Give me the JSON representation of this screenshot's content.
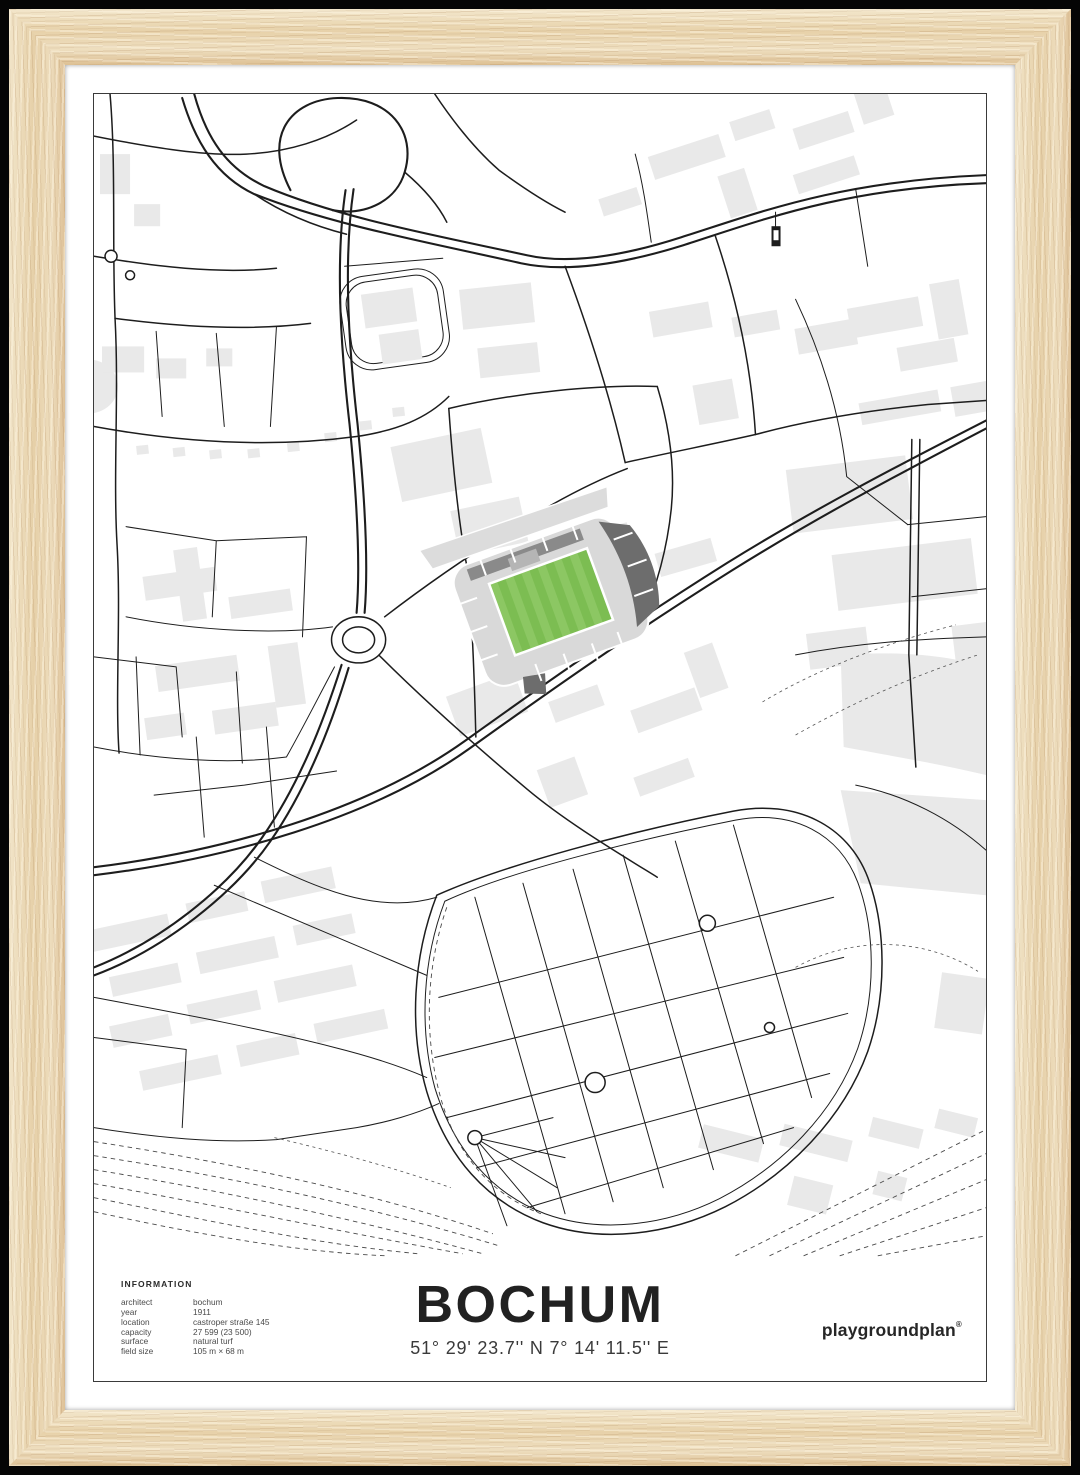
{
  "poster": {
    "title": "BOCHUM",
    "coordinates": "51° 29' 23.7'' N  7° 14' 11.5'' E",
    "brand": "playgroundplan",
    "brand_mark": "®",
    "info": {
      "heading": "INFORMATION",
      "rows": [
        {
          "label": "architect",
          "value": "bochum"
        },
        {
          "label": "year",
          "value": "1911"
        },
        {
          "label": "location",
          "value": "castroper straße 145"
        },
        {
          "label": "capacity",
          "value": "27 599 (23 500)"
        },
        {
          "label": "surface",
          "value": "natural turf"
        },
        {
          "label": "field size",
          "value": "105 m × 68 m"
        }
      ]
    }
  },
  "colors": {
    "frame_wood_light": "#f3e7cc",
    "frame_wood_dark": "#ddc093",
    "mat": "#ffffff",
    "poster_border": "#3a3a3a",
    "map_line": "#1d1d1d",
    "building_gray": "#e9e9e9",
    "stand_light": "#d9d9d9",
    "stand_dark": "#6d6d6d",
    "pitch_green_dark": "#7cbd52",
    "pitch_green_light": "#8cc763",
    "text_dark": "#212121",
    "text_gray": "#4a4a4a"
  }
}
